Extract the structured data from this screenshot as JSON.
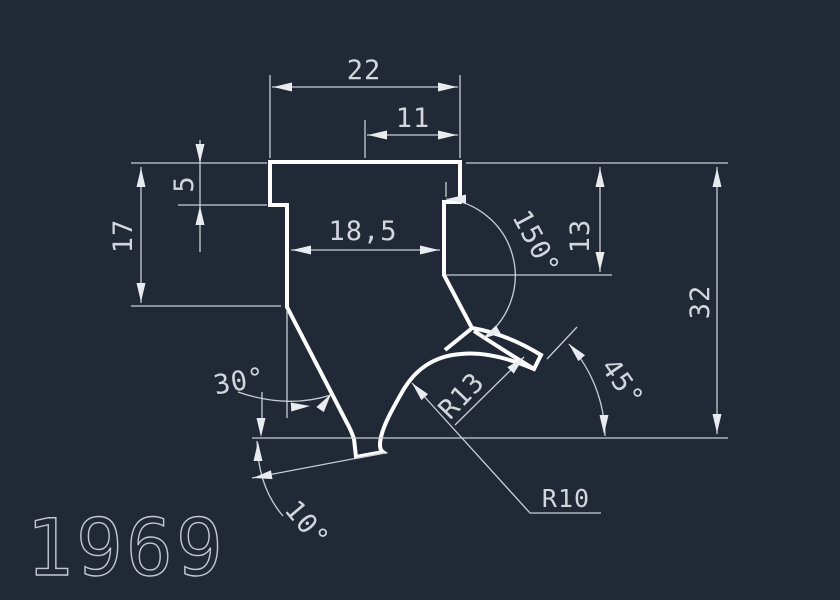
{
  "drawing": {
    "title": "1969",
    "colors": {
      "background": "#222936",
      "profile_line": "#ffffff",
      "dimension_line": "#c9ced6",
      "text": "#d2d7de"
    },
    "labels": {
      "top_width": "22",
      "top_inner_width": "11",
      "step_depth": "5",
      "left_height": "17",
      "neck_width": "18,5",
      "right_upper_height": "13",
      "overall_height": "32",
      "neck_angle": "150°",
      "slant_angle": "30°",
      "tip_angle": "45°",
      "base_angle": "10°",
      "hook_radius": "R13",
      "bottom_radius": "R10"
    }
  }
}
